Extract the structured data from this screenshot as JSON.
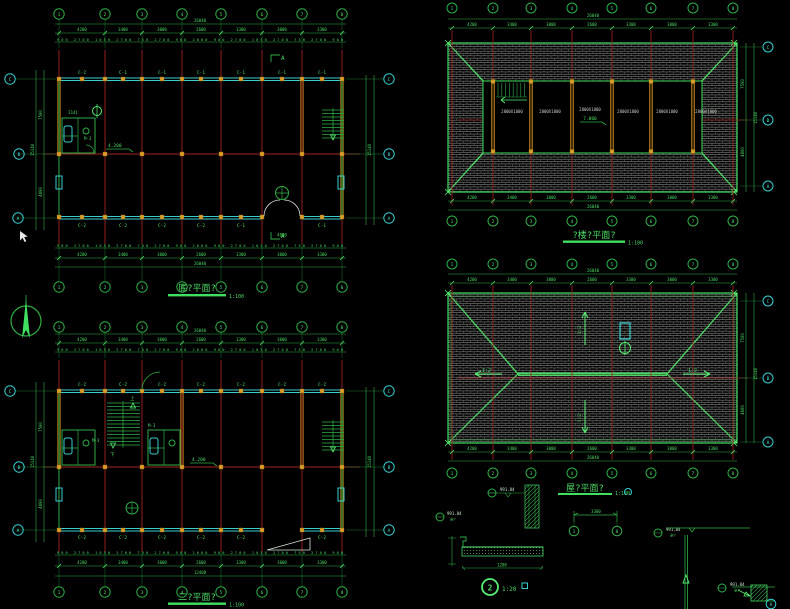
{
  "colors": {
    "background": "#000000",
    "line_green": "#2fae46",
    "bright_green": "#58ef72",
    "grid_red": "#a32424",
    "window_cyan": "#38cfcf",
    "column_yellow": "#d8a02a",
    "tile_gray": "#8f938f",
    "label_gray": "#c9cfc9"
  },
  "grid": {
    "cols": [
      "1",
      "2",
      "3",
      "4",
      "5",
      "6",
      "7",
      "8"
    ],
    "rows": [
      "C",
      "B",
      "A"
    ]
  },
  "dims": {
    "overall": "26040",
    "bays": [
      "4200",
      "3400",
      "3000",
      "2600",
      "3300",
      "3000",
      "3300"
    ],
    "sub_row": "900 2700 1050 2700 750 2700 900 2600 900 2700 1050 2700 750 2700 900",
    "v_overall": "15140",
    "v_rows": [
      "7500",
      "4800"
    ],
    "second_overall": "12408",
    "door": "4000",
    "bath": "2141"
  },
  "plans": {
    "ground": {
      "title": "底?平面?",
      "scale": "1:100",
      "level": "4.200",
      "section_mark": "A",
      "top_windows": [
        "C-2",
        "C-1",
        "C-1",
        "C-1",
        "C-1",
        "C-1",
        "C-1"
      ],
      "bottom_windows": [
        "C-2",
        "C-2",
        "C-2",
        "C-2",
        "C-1",
        "C-1"
      ],
      "door_label": "M-3"
    },
    "second": {
      "title": "二?平面?",
      "scale": "1:100",
      "level": "4.200",
      "top_windows": [
        "C-2",
        "C-2",
        "C-2",
        "C-2",
        "C-2",
        "C-2",
        "C-2"
      ],
      "bottom_windows": [
        "C-2",
        "C-2",
        "C-2",
        "C-2",
        "C-2",
        "C-2"
      ],
      "stair_up": "上",
      "stair_down": "下",
      "door_labels": [
        "M-3",
        "M-3"
      ]
    },
    "attic": {
      "title": "?楼?平面?",
      "scale": "1:100",
      "level": "7.000",
      "rooms": [
        "2800X1800",
        "2800X1800",
        "2800X1800",
        "2800X1800",
        "2800X1800",
        "2800X1800"
      ]
    },
    "roof": {
      "title": "屋?平面?",
      "scale": "1:100",
      "slope_h": "1:2",
      "slope_v": "1:2"
    }
  },
  "details": {
    "eave": {
      "bubble": "2",
      "scale": "1:20",
      "elev_top": "991.84",
      "elev_side": "991.84",
      "note": "全?",
      "dim": "1200"
    },
    "key": {
      "dim": "3300",
      "left_bubble": "1",
      "right_bubble": "8"
    },
    "right": {
      "elev": "991.84",
      "note": "全?"
    },
    "corner": {
      "elev": "991.84",
      "note": "全?",
      "bubble": "A"
    }
  }
}
